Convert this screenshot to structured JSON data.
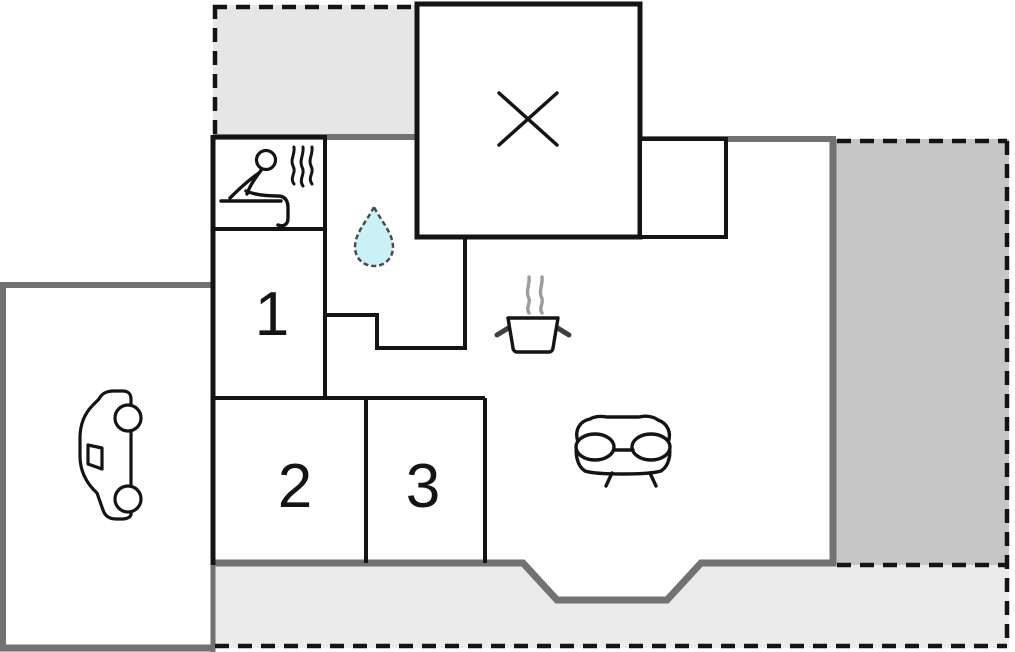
{
  "plan": {
    "room_labels": {
      "room1": "1",
      "room2": "2",
      "room3": "3"
    },
    "rooms": [
      {
        "name": "bedroom-1",
        "label": "1"
      },
      {
        "name": "bedroom-2",
        "label": "2"
      },
      {
        "name": "bedroom-3",
        "label": "3"
      },
      {
        "name": "sauna",
        "icon": "sauna-icon"
      },
      {
        "name": "bathroom",
        "icon": "water-drop-icon"
      },
      {
        "name": "kitchen",
        "icon": "cooking-pot-icon"
      },
      {
        "name": "living-room",
        "icon": "sofa-icon"
      },
      {
        "name": "carport",
        "icon": "car-icon"
      },
      {
        "name": "crossed-out-room",
        "icon": "x-mark-icon"
      },
      {
        "name": "terrace-top-left",
        "icon": ""
      },
      {
        "name": "terrace-right",
        "icon": ""
      },
      {
        "name": "terrace-bottom",
        "icon": ""
      }
    ]
  },
  "colors": {
    "background": "#ffffff",
    "wall_exterior": "#727272",
    "wall_interior": "#141414",
    "terrace_top": "#e6e6e6",
    "terrace_right": "#c6c6c6",
    "terrace_bottom": "#ebebeb",
    "water_drop": "#c9f1f6",
    "steam": "#9c9c9c",
    "pot_handle": "#3f3f3f"
  }
}
